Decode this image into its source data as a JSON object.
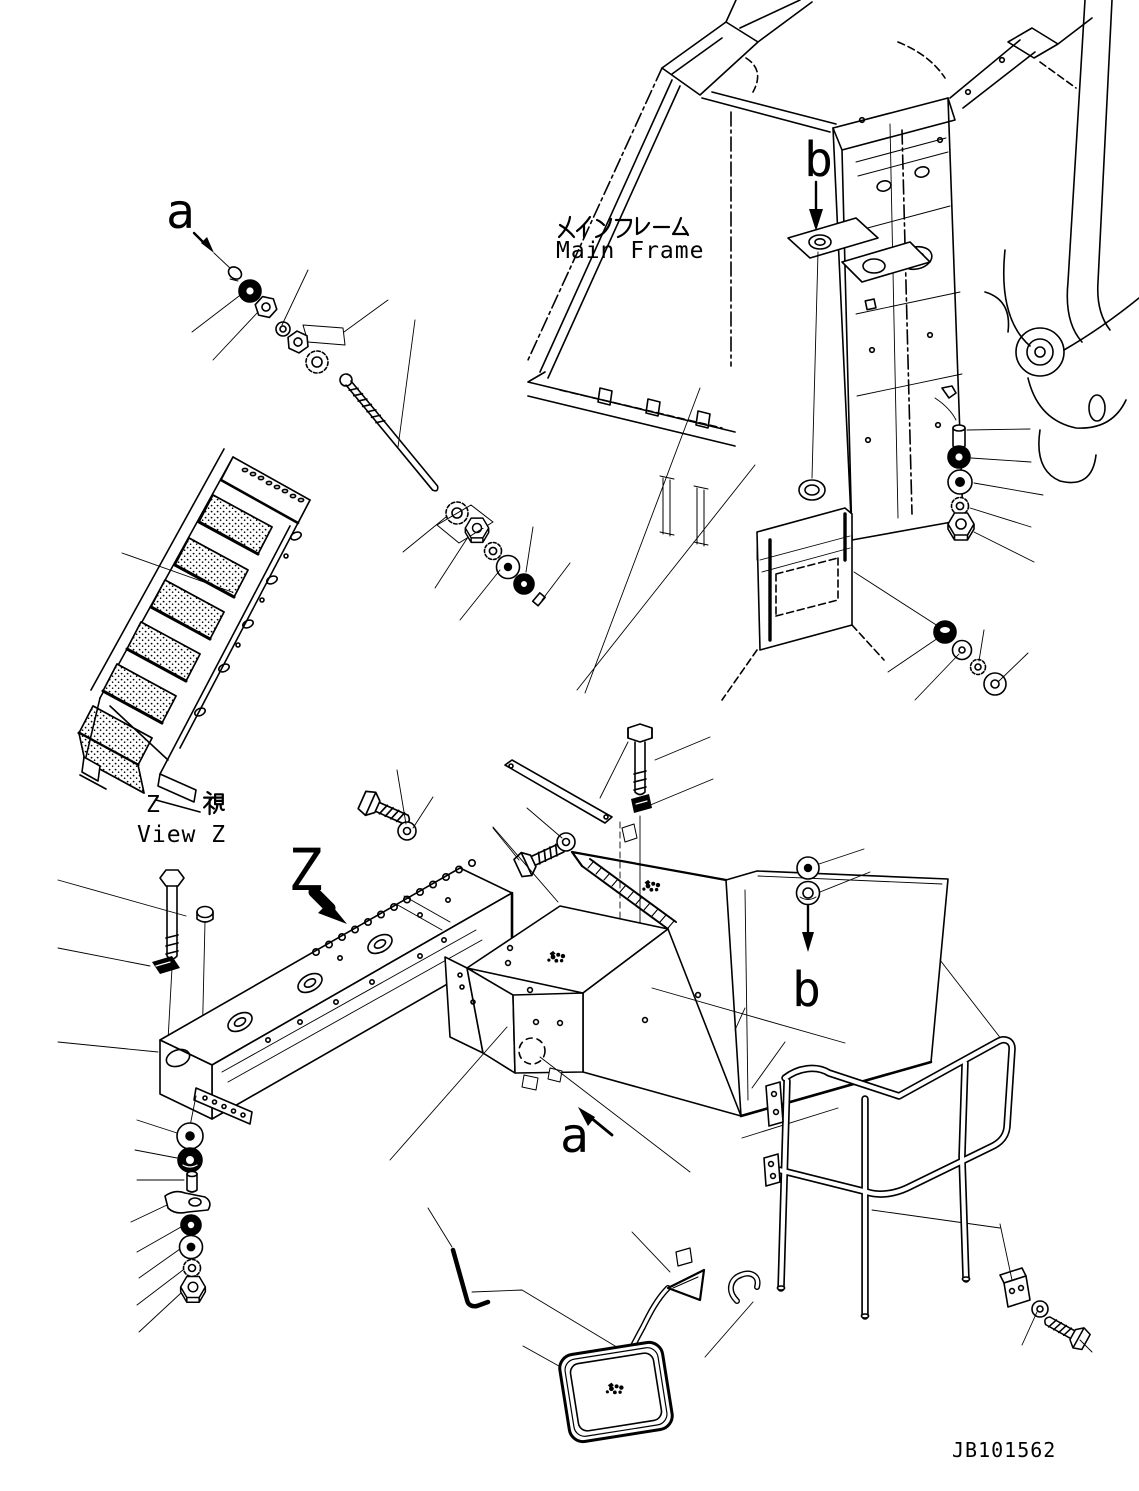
{
  "page": {
    "background_color": "#ffffff",
    "line_color": "#000000"
  },
  "diagram": {
    "kind": "exploded-parts-drawing",
    "labels": {
      "main_frame_jp": "メインフレーム",
      "main_frame_en": "Main Frame",
      "view_z_letter": "Z",
      "view_z_kanji": "視",
      "view_z_en": "View Z",
      "big_arrow_letter": "Z",
      "detail_a": "a",
      "detail_b": "b",
      "drawing_number": "JB101562"
    }
  }
}
